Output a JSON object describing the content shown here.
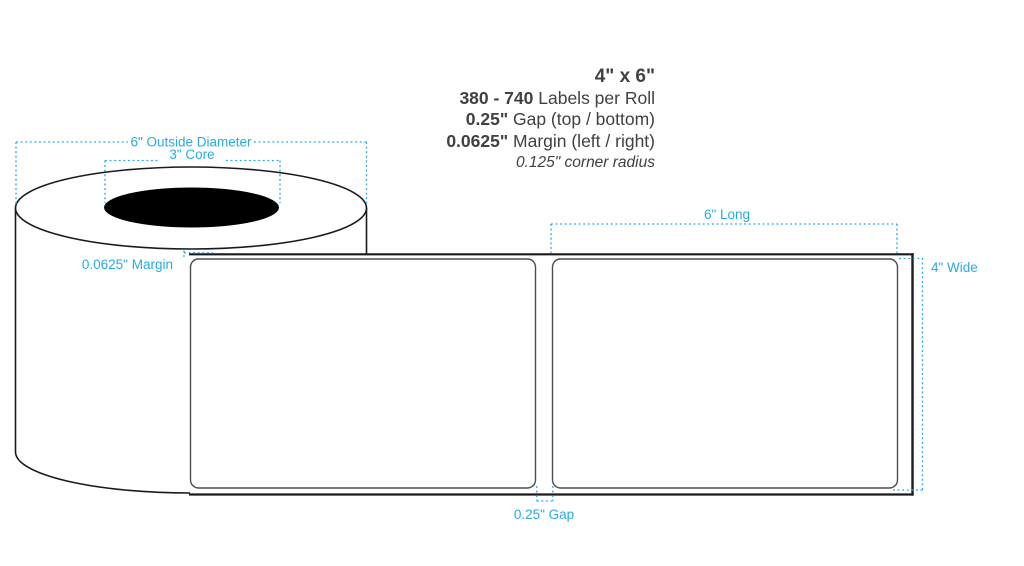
{
  "specs": {
    "size": "4\" x 6\"",
    "labels_per_roll": {
      "bold": "380 - 740",
      "rest": " Labels per Roll"
    },
    "gap": {
      "bold": "0.25\"",
      "rest": " Gap (top / bottom)"
    },
    "margin": {
      "bold": "0.0625\"",
      "rest": " Margin (left / right)"
    },
    "corner_radius": "0.125\" corner radius"
  },
  "dimensions": {
    "outside_diameter": "6\" Outside Diameter",
    "core": "3\" Core",
    "left_margin": "0.0625\" Margin",
    "length": "6\" Long",
    "width": "4\" Wide",
    "gap": "0.25\" Gap"
  },
  "colors": {
    "dimension_accent": "#29ABE2",
    "spec_text": "#414042",
    "diagram_outline": "#1A1A1A",
    "label_outline": "#4D4D4D",
    "core_fill": "#000000",
    "background": "#FFFFFF"
  }
}
